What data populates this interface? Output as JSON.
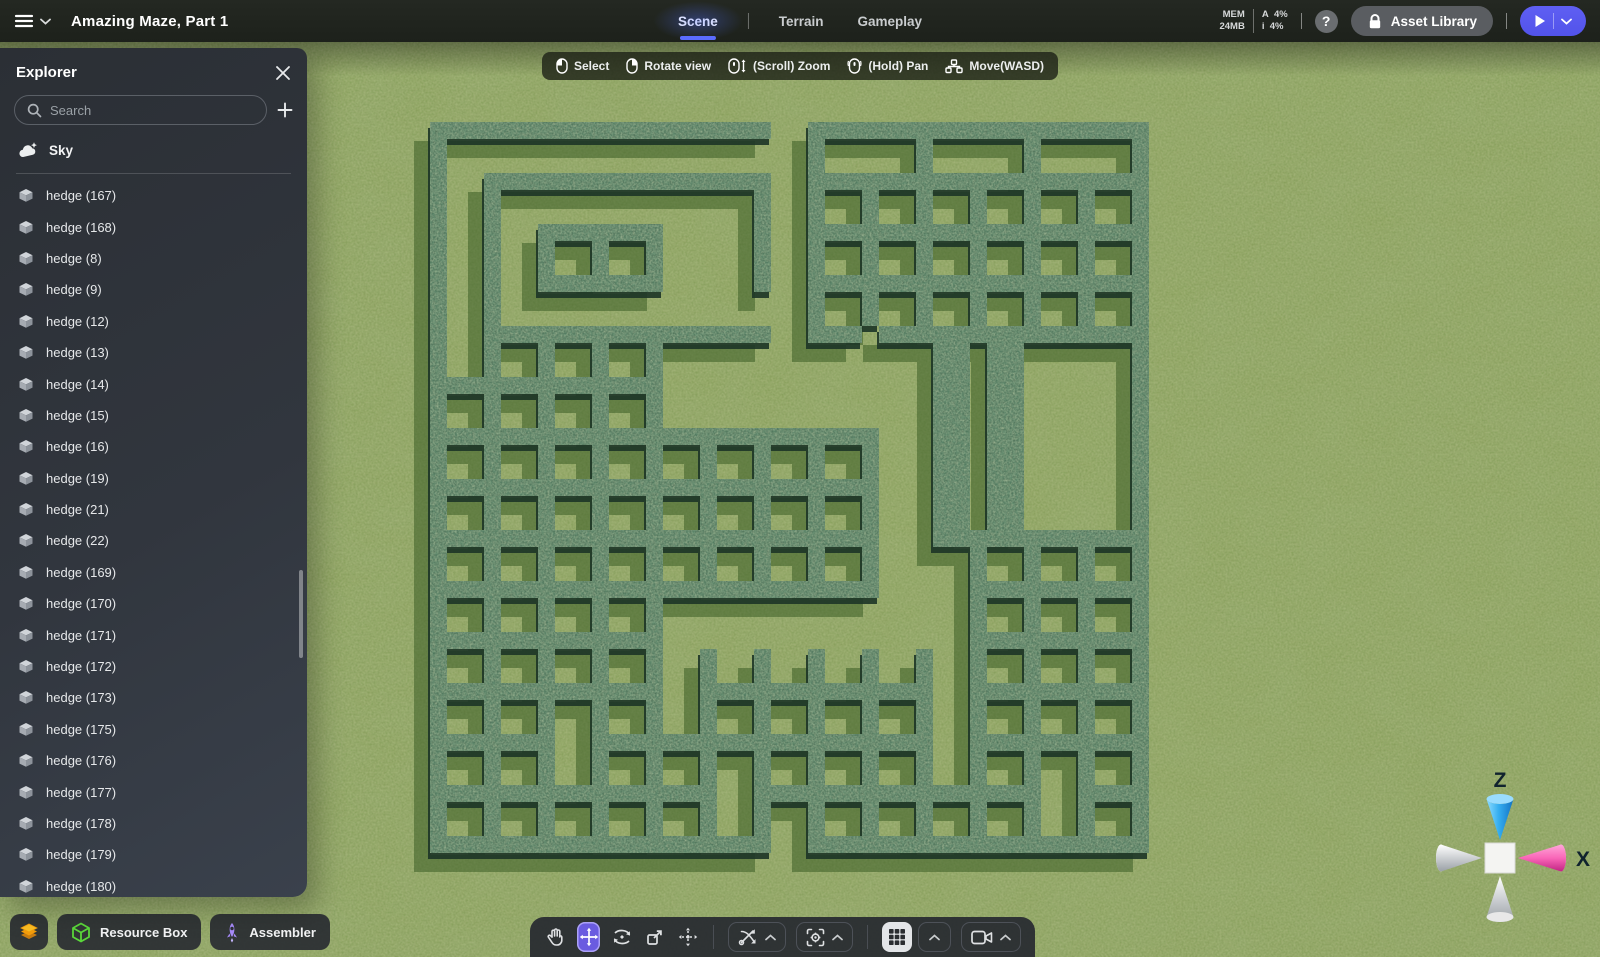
{
  "topbar": {
    "title": "Amazing Maze, Part 1",
    "tabs": [
      {
        "label": "Scene",
        "active": true
      },
      {
        "label": "Terrain",
        "active": false
      },
      {
        "label": "Gameplay",
        "active": false
      }
    ],
    "stats": {
      "mem_label": "MEM",
      "mem_value": "24MB",
      "cpu_label": "A",
      "cpu_value": "4%",
      "fps_label": "i",
      "fps_value": "4%"
    },
    "help_label": "?",
    "asset_library_label": "Asset Library"
  },
  "hint_bar": {
    "items": [
      {
        "icon": "mouse-left-icon",
        "label": "Select"
      },
      {
        "icon": "mouse-right-icon",
        "label": "Rotate view"
      },
      {
        "icon": "mouse-scroll-icon",
        "label": "(Scroll) Zoom"
      },
      {
        "icon": "mouse-hold-icon",
        "label": "(Hold) Pan"
      },
      {
        "icon": "move-keys-icon",
        "label": "Move(WASD)"
      }
    ]
  },
  "explorer": {
    "title": "Explorer",
    "search_placeholder": "Search",
    "sky_label": "Sky",
    "items": [
      "hedge (167)",
      "hedge (168)",
      "hedge (8)",
      "hedge (9)",
      "hedge (12)",
      "hedge (13)",
      "hedge (14)",
      "hedge (15)",
      "hedge (16)",
      "hedge (19)",
      "hedge (21)",
      "hedge (22)",
      "hedge (169)",
      "hedge (170)",
      "hedge (171)",
      "hedge (172)",
      "hedge (173)",
      "hedge (175)",
      "hedge (176)",
      "hedge (177)",
      "hedge (178)",
      "hedge (179)",
      "hedge (180)"
    ]
  },
  "dock": {
    "resource_box_label": "Resource Box",
    "assembler_label": "Assembler"
  },
  "gizmo": {
    "up_label": "Z",
    "right_label": "X"
  },
  "accent": {
    "play": "#5a5cf2",
    "tab_underline": "#5b6cff",
    "tool_active": "#6a5be0"
  },
  "maze": {
    "colors": {
      "grass": "#7b984e",
      "shadow": "#3c5e26",
      "side": "#1d3527",
      "hedge": "#42614b",
      "hedge_light": "#a9c47e",
      "hedge_dark": "#16301f"
    },
    "grid": [
      "#############.#############",
      "#.............#...#...#...#",
      "#.###########.#############",
      "#.#.........#.#.#.#.#.#.#.#",
      "#.#.#####...#.#############",
      "#.#.#.#.#...#.#.#.#.#.#.#.#",
      "#.#.#####...#.#############",
      "#.#...........#.#.#.#.#.#.#",
      "#.###########.##.##########",
      "#.#.#.#.#..........#.#....#",
      "#########..........#.#....#",
      "#.#.#.#.#..........#.#....#",
      "#################..#.#....#",
      "#.#.#.#.#.#.#.#.#..#.#....#",
      "#################..#.#....#",
      "#.#.#.#.#.#.#.#.#..#.#....#",
      "#################..########",
      "#.#.#.#.#.#.#.#.#...#.#.#.#",
      "#################...#######",
      "#.#.#.#.#...........#.#.#.#",
      "#########...........#######",
      "#.#.#.#.#.#.#.#.#.#.#.#.#.#",
      "#########.#########.#######",
      "#.#.#.#.#.#.#.#.#.#.#.#.#.#",
      "#####.#############.#######",
      "#.#.#.#.#.#.#.#.#.#.#.#.#.#",
      "###########.###########.###",
      "#.#.#.#.#.#.#.#.#.#.#.#.#.#",
      "#############.#############"
    ]
  }
}
